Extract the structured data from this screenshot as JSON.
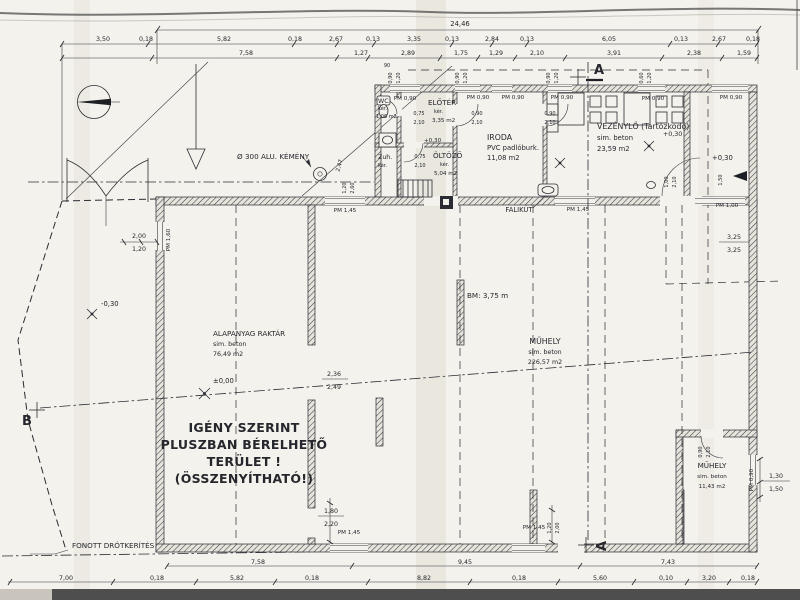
{
  "rooms": {
    "wc": {
      "name": "WC",
      "finish": "kér.",
      "area": "1,06 m2"
    },
    "zuh": {
      "name": "Zuh.",
      "finish": "kér."
    },
    "eloter": {
      "name": "ELŐTÉR",
      "finish": "kér.",
      "area": "3,35 m2"
    },
    "oltozo": {
      "name": "ÖLTÖZŐ",
      "finish": "kér.",
      "area": "5,04 m2"
    },
    "iroda": {
      "name": "IRODA",
      "finish": "PVC padlóburk.",
      "area": "11,08 m2"
    },
    "vezenylo": {
      "name": "VEZÉNYLŐ (Tartózkodó)",
      "finish": "sim. beton",
      "area": "23,59 m2"
    },
    "raktar": {
      "name": "ALAPANYAG RAKTÁR",
      "finish": "sim. beton",
      "area": "76,49 m2"
    },
    "muhely": {
      "name": "MŰHELY",
      "finish": "sim. beton",
      "area": "226,57 m2"
    },
    "muhely_kis": {
      "name": "MŰHELY",
      "finish": "sim. beton",
      "area": "11,43 m2"
    }
  },
  "notes": {
    "rentable_1": "IGÉNY SZERINT",
    "rentable_2": "PLUSZBAN BÉRELHETŐ",
    "rentable_3": "TERÜLET !",
    "rentable_4": "(ÖSSZENYÍTHATÓ!)",
    "fence": "FONOTT DRÓTKERÍTÉS",
    "chimney": "Ø 300 ALU. KÉMÉNY",
    "wall_sink": "FALIKÚT",
    "clear_height": "BM: 3,75 m"
  },
  "levels": {
    "zero": "±0,00",
    "minus": "-0,30",
    "plus": "+0,30"
  },
  "sections": {
    "a": "A",
    "b": "B"
  },
  "pm": {
    "p090": "PM 0,90",
    "p145": "PM 1,45",
    "p100": "PM 1,00",
    "p160": "PM 1,60"
  },
  "dims": {
    "total": "24,46",
    "row2": [
      "3,50",
      "0,18",
      "5,82",
      "0,18",
      "2,67",
      "0,13",
      "3,35",
      "0,13",
      "2,84",
      "0,13",
      "6,05",
      "0,13",
      "2,67",
      "0,18"
    ],
    "row3": [
      "7,58",
      "1,27",
      "2,89",
      "1,75",
      "1,29",
      "2,10",
      "3,91",
      "2,38",
      "1,59"
    ],
    "bottom1": [
      "7,58",
      "9,45",
      "7,43"
    ],
    "bottom2": [
      "7,00",
      "0,18",
      "5,82",
      "0,18",
      "8,82",
      "0,18",
      "5,60",
      "0,10",
      "3,20",
      "0,18"
    ],
    "left_stack": [
      "2,00",
      "1,20"
    ],
    "right_stack": [
      "1,30",
      "1,50"
    ],
    "room325": [
      "3,25",
      "3,25"
    ],
    "bay": [
      "2,36",
      "2,49"
    ],
    "door_b": [
      "1,80",
      "2,20"
    ],
    "door_s": [
      "1,20",
      "2,00"
    ],
    "chimney_v": [
      "2,47",
      "1,20",
      "2,60"
    ],
    "door075": [
      "0,75",
      "2,10"
    ],
    "door090": [
      "0,90",
      "2,10"
    ],
    "door100": [
      "1,00",
      "2,10"
    ],
    "r150": "1,50",
    "micro": [
      "0,90",
      "1,20",
      "0,90",
      "1,20",
      "0,90",
      "1,20",
      "0,60",
      "1,20",
      "90"
    ]
  }
}
